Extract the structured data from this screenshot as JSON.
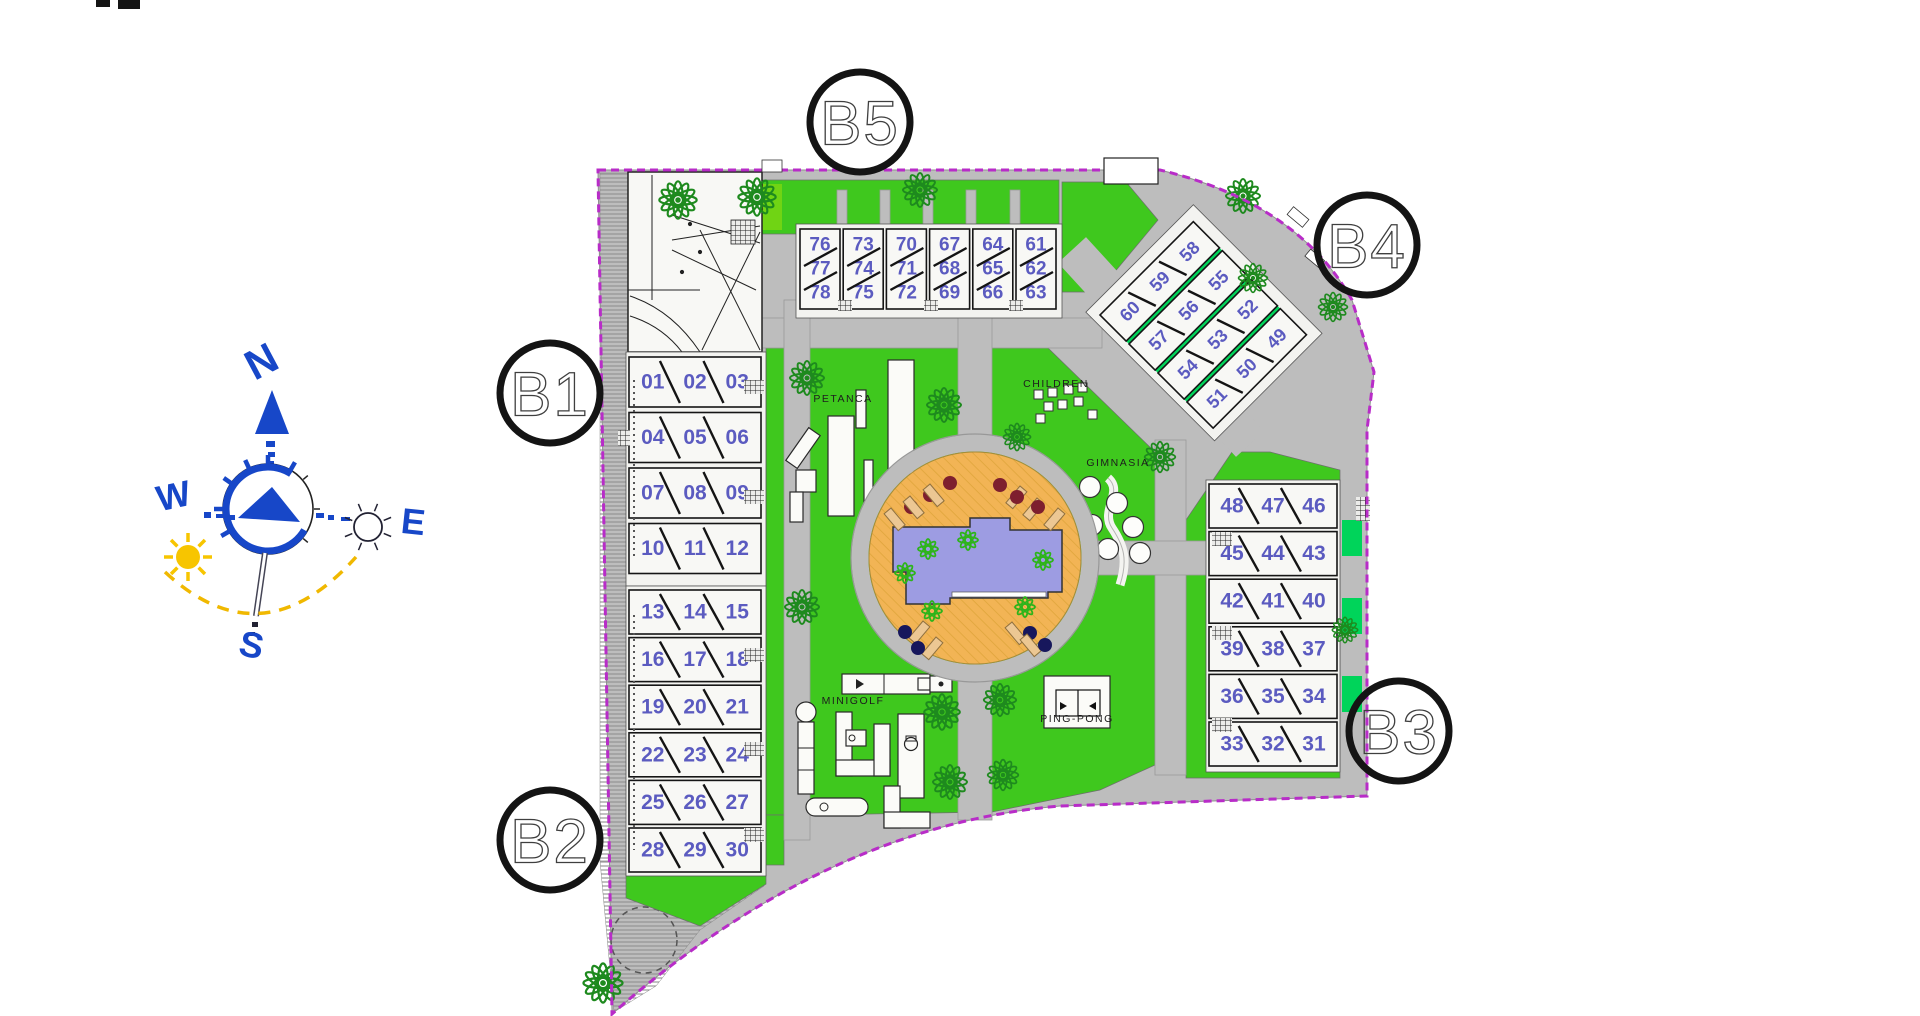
{
  "compass": {
    "north": "N",
    "south": "S",
    "east": "E",
    "west": "W"
  },
  "blocks": {
    "b1": {
      "label": "B1",
      "units": [
        [
          "01",
          "02",
          "03"
        ],
        [
          "04",
          "05",
          "06"
        ],
        [
          "07",
          "08",
          "09"
        ],
        [
          "10",
          "11",
          "12"
        ]
      ]
    },
    "b2": {
      "label": "B2",
      "units": [
        [
          "13",
          "14",
          "15"
        ],
        [
          "16",
          "17",
          "18"
        ],
        [
          "19",
          "20",
          "21"
        ],
        [
          "22",
          "23",
          "24"
        ],
        [
          "25",
          "26",
          "27"
        ],
        [
          "28",
          "29",
          "30"
        ]
      ]
    },
    "b3": {
      "label": "B3",
      "units": [
        [
          "48",
          "47",
          "46"
        ],
        [
          "45",
          "44",
          "43"
        ],
        [
          "42",
          "41",
          "40"
        ],
        [
          "39",
          "38",
          "37"
        ],
        [
          "36",
          "35",
          "34"
        ],
        [
          "33",
          "32",
          "31"
        ]
      ]
    },
    "b4": {
      "label": "B4",
      "units": [
        [
          "60",
          "59",
          "58"
        ],
        [
          "57",
          "56",
          "55"
        ],
        [
          "54",
          "53",
          "52"
        ],
        [
          "51",
          "50",
          "49"
        ]
      ]
    },
    "b5": {
      "label": "B5",
      "units": [
        [
          "76",
          "77",
          "78"
        ],
        [
          "73",
          "74",
          "75"
        ],
        [
          "70",
          "71",
          "72"
        ],
        [
          "67",
          "68",
          "69"
        ],
        [
          "64",
          "65",
          "66"
        ],
        [
          "61",
          "62",
          "63"
        ]
      ]
    }
  },
  "amenities": {
    "petanca": "PETANCA",
    "children": "CHILDREN",
    "gimnasia": "GIMNASIA",
    "minigolf": "MINIGOLF",
    "pingpong": "PING-PONG"
  },
  "colors": {
    "lawn": "#3fc81e",
    "lawn_bright": "#70d414",
    "accent_green": "#00d45a",
    "road": "#bdbdbd",
    "pool_deck": "#f2b455",
    "pool_water": "#9d9ce2",
    "boundary_purple": "#b82cc8",
    "unit_number_blue": "#5b5bc0",
    "compass_blue": "#1747c8",
    "sun_yellow": "#f7c500",
    "tree_green": "#1e8a1e"
  }
}
